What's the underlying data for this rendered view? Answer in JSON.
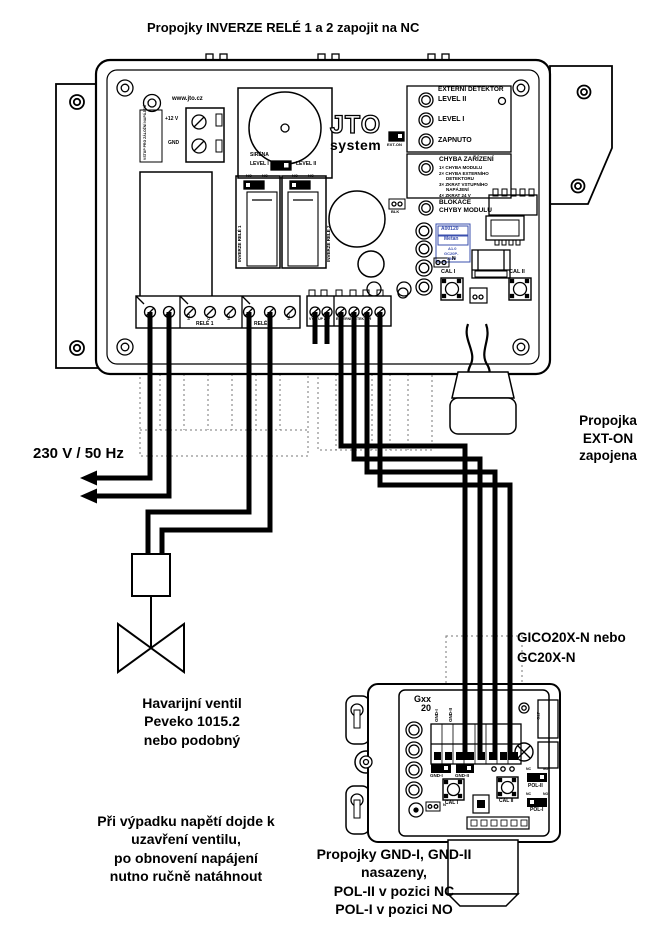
{
  "title": "Propojky INVERZE RELÉ 1 a 2 zapojit na NC",
  "colors": {
    "ink": "#000000",
    "paper": "#ffffff",
    "sticker_text": "#3a4fae",
    "ghost": "#777777"
  },
  "board": {
    "url": "www.jto.cz",
    "backup_label": "VSTUP PRO ZÁLOŽNÍ NAPÁJENÍ",
    "plus12": "+12 V",
    "gnd": "GND",
    "siren": "SIRÉNA",
    "siren_level1": "LEVEL I",
    "siren_level2": "LEVEL II",
    "logo": "JTO",
    "logo_sub": "system",
    "relay1_vertical": "INVERZE RELÉ 1",
    "relay2_vertical": "INVERZE RELÉ 2",
    "no": "NO",
    "nc": "NC",
    "detector_header": "EXTERNÍ DETEKTOR",
    "led_level2": "LEVEL II",
    "led_level1": "LEVEL I",
    "led_on": "ZAPNUTO",
    "ext_on": "EXT-ON",
    "fault_header": "CHYBA ZAŘÍZENÍ",
    "fault_lines": [
      "1× CHYBA MODULU",
      "2× CHYBA EXTERNÍHO",
      "DETEKTORU",
      "3× ZKRAT VSTUPNÍHO",
      "NAPÁJENÍ",
      "4× ZKRAT 24 V"
    ],
    "block_line1": "BLOKACE",
    "block_line2": "CHYBY MODULU",
    "blk": "BLK",
    "sticker": {
      "l1": "A00120",
      "l2": "Metan",
      "l3": "A1.0",
      "l4": "GC20P-",
      "l5": "230V"
    },
    "n": "N",
    "cal1": "CAL I",
    "cal2": "CAL II",
    "term_rele1": "RELÉ 1",
    "term_rele2": "RELÉ 2",
    "term_vystup": "VÝSTUP 24V",
    "term_ext": "EXTERNÍ DETEKTOR",
    "pin_labels": [
      "NO",
      "C",
      "NC"
    ]
  },
  "annotations": {
    "mains": "230 V / 50 Hz",
    "ext_on": [
      "Propojka",
      "EXT-ON",
      "zapojena"
    ],
    "gico": [
      "GICO20X-N nebo",
      "GC20X-N"
    ],
    "valve": [
      "Havarijní ventil",
      "Peveko 1015.2",
      "nebo podobný"
    ],
    "outage": [
      "Při výpadku napětí dojde k",
      "uzavření ventilu,",
      "po obnovení napájení",
      "nutno ručně natáhnout"
    ],
    "jumpers": [
      "Propojky GND-I, GND-II",
      "nasazeny,",
      "POL-II v pozici NC",
      "POL-I v pozici NO"
    ]
  },
  "detector": {
    "logo1": "Gxx",
    "logo2": "20",
    "gnd1_vert": "GND-I",
    "gnd2_vert": "GND-II",
    "gnd1": "GND-I",
    "gnd2": "GND-II",
    "cal1": "CAL I",
    "cal2": "CAL II",
    "pol2": "POL-II",
    "pol1": "POL-I",
    "nc": "NC",
    "no": "NO",
    "n": "N",
    "side": "JTO"
  }
}
